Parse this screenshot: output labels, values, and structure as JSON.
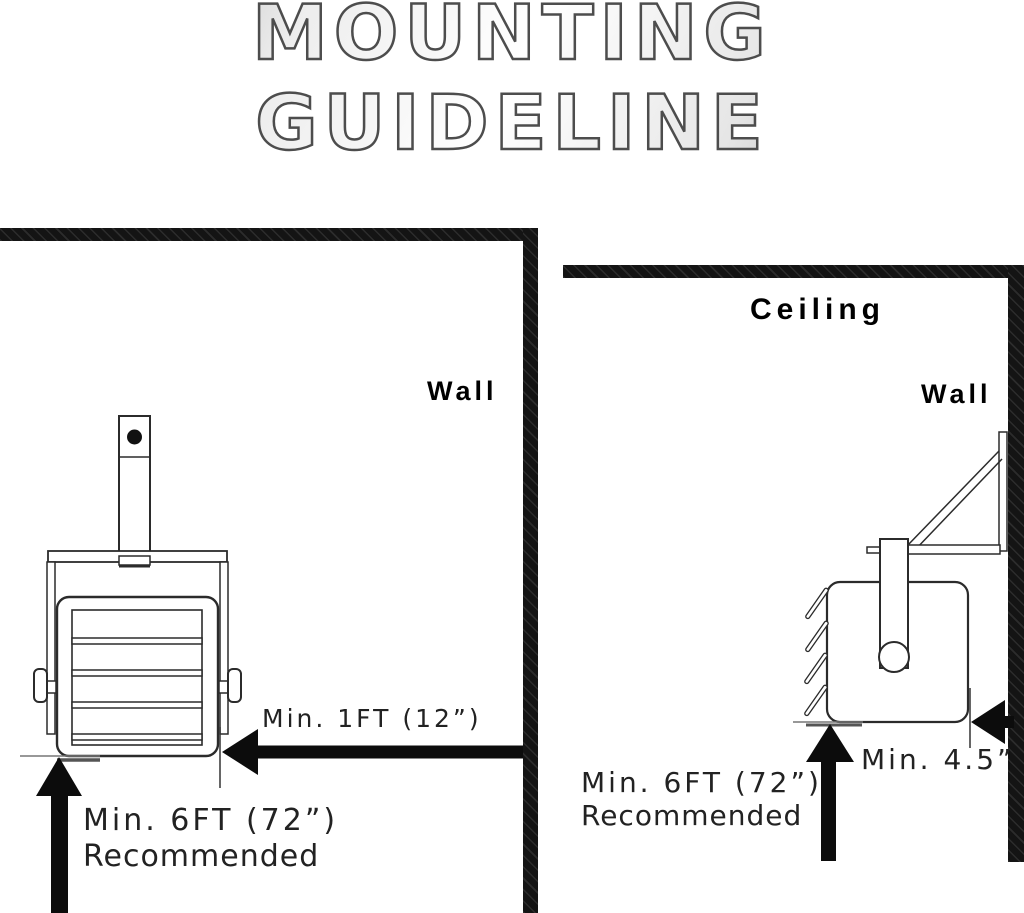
{
  "title": {
    "line1": "MOUNTING",
    "line2": "GUIDELINE"
  },
  "left_diagram": {
    "name": "wall-clearance-front-view",
    "wall_label": "Wall",
    "side_clearance": "Min. 1FT (12”)",
    "floor_clearance": "Min. 6FT (72”)",
    "floor_note": "Recommended"
  },
  "right_diagram": {
    "name": "ceiling-mount-side-view",
    "ceiling_label": "Ceiling",
    "wall_label": "Wall",
    "side_clearance": "Min. 4.5”",
    "floor_clearance": "Min. 6FT (72”)",
    "floor_note": "Recommended"
  },
  "colors": {
    "line_art": "#2b2b2b",
    "structure": "#141414",
    "arrow": "#0c0c0c",
    "title_stroke": "#4d4d4d",
    "title_gradient": [
      "#8e8e8e",
      "#ffffff",
      "#8a8a8a"
    ]
  }
}
